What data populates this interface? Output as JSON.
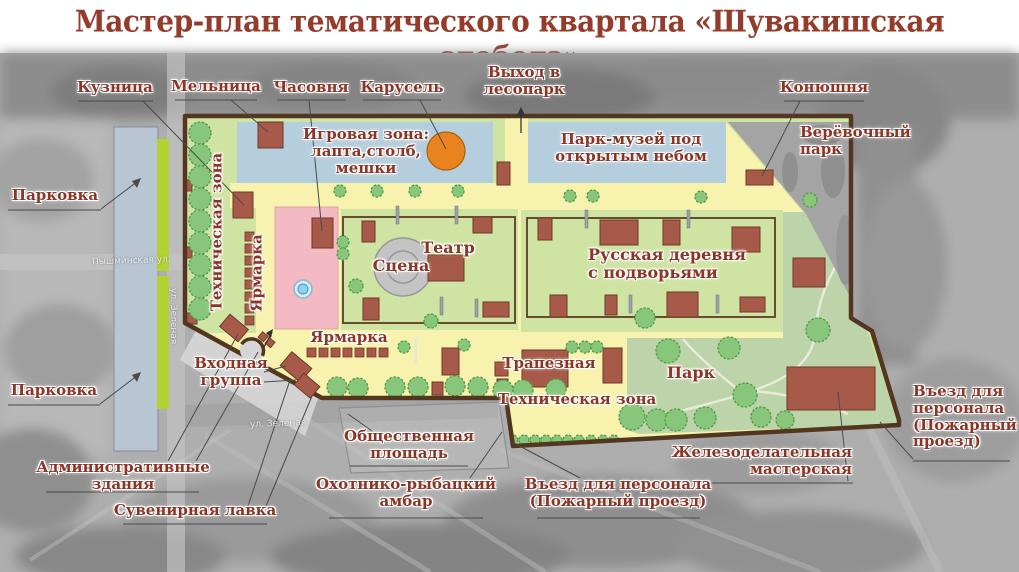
{
  "title": "Мастер-план тематического квартала «Шувакишская слобода»",
  "labels": {
    "kuznitsa": "Кузница",
    "melnitsa": "Мельница",
    "chasovnya": "Часовня",
    "karusel": "Карусель",
    "vyhod_lesopark": "Выход в\nлесопарк",
    "konyushnya": "Конюшня",
    "verevochny_park": "Верёвочный\nпарк",
    "parkovka_top": "Парковка",
    "parkovka_bottom": "Парковка",
    "igrovaya_zona": "Игровая зона:\nлапта,столб,\nмешки",
    "park_muzey": "Парк-музей под\nоткрытым небом",
    "tekh_zona_left": "Техническая зона",
    "yarmarka_left": "Ярмарка",
    "scena": "Сцена",
    "teatr": "Театр",
    "russkaya_derevnya": "Русская деревня\nс подворьями",
    "yarmarka_bottom": "Ярмарка",
    "vkhodnaya_gruppa": "Входная\nгруппа",
    "trapeznaya": "Трапезная",
    "park": "Парк",
    "tekh_zona_bottom": "Техническая зона",
    "obshchestvennaya_ploshchad": "Общественная\nплощадь",
    "administrativnye_zdaniya": "Административные\nздания",
    "suvenirnaya_lavka": "Сувенирная лавка",
    "okhotniko_rybatsky_ambar": "Охотнико-рыбацкий\nамбар",
    "vyezd_personala_bottom": "Въезд для персонала\n(Пожарный проезд)",
    "zhelezodelatelnaya_masterskaya": "Железоделательная\nмастерская",
    "vyezd_personala_right": "Въезд для\nперсонала\n(Пожарный\nпроезд)"
  },
  "streets": {
    "pyshminskaya": "Пышминская ул.",
    "zelenaya": "ул. Зеленая"
  },
  "colors": {
    "title_text": "#943b2b",
    "label_text": "#8a3526",
    "site_green": "#cfe3a2",
    "path_yellow": "#f7f2ad",
    "zone_blue": "#b5cedd",
    "fair_pink": "#f3bac3",
    "building_brown": "#a75a49",
    "boundary_brown": "#533620",
    "tree_green": "#87c67b",
    "park_green": "#bdd3a9",
    "parking_gray_blue": "#bac5d3",
    "lime_strip": "#b3d233",
    "carousel_orange": "#e8831e",
    "stage_gray": "#c4c4c4"
  }
}
